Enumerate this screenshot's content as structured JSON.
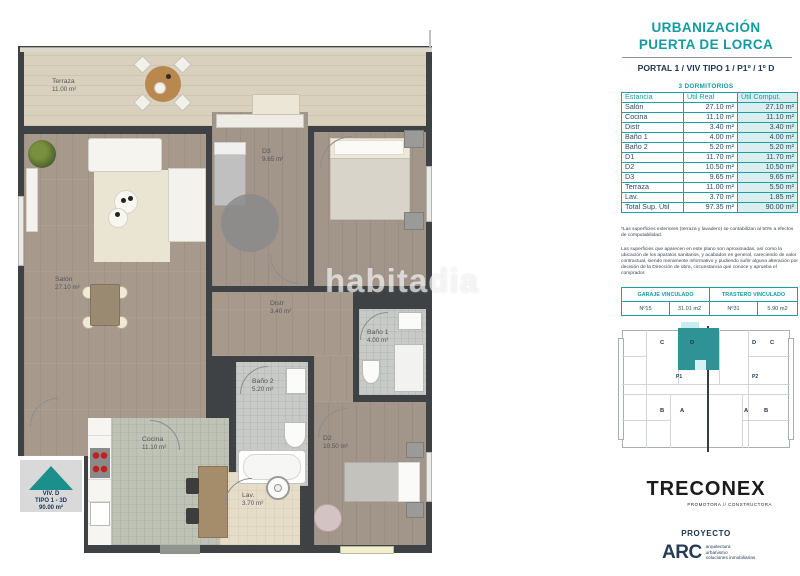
{
  "header": {
    "title_line1": "URBANIZACIÓN",
    "title_line2": "PUERTA DE LORCA",
    "subtitle": "PORTAL 1 / VIV TIPO 1 / P1º / 1º D",
    "bedrooms_label": "3 DORMITORIOS"
  },
  "area_table": {
    "columns": [
      "Estancia",
      "Útil Real",
      "Útil Comput."
    ],
    "rows": [
      [
        "Salón",
        "27.10 m²",
        "27.10 m²"
      ],
      [
        "Cocina",
        "11.10 m²",
        "11.10 m²"
      ],
      [
        "Distr",
        "3.40 m²",
        "3.40 m²"
      ],
      [
        "Baño 1",
        "4.00 m²",
        "4.00 m²"
      ],
      [
        "Baño 2",
        "5.20 m²",
        "5.20 m²"
      ],
      [
        "D1",
        "11.70 m²",
        "11.70 m²"
      ],
      [
        "D2",
        "10.50 m²",
        "10.50 m²"
      ],
      [
        "D3",
        "9.65 m²",
        "9.65 m²"
      ],
      [
        "Terraza",
        "11.00 m²",
        "5.50 m²"
      ],
      [
        "Lav.",
        "3.70 m²",
        "1.85 m²"
      ]
    ],
    "total_row": [
      "Total Sup. Útil",
      "97.35 m²",
      "90.00 m²"
    ]
  },
  "notes": {
    "note1": "*Las superficies exteriores (terraza y lavadero) se contabilizan al 50% a efectos de computabilidad.",
    "note2": "Las superficies que aparecen en este plano son aproximadas, así como la ubicación de los aparatos sanitarios, y acabados en general, careciendo de valor contractual, siendo meramente informativo y pudiendo sufrir alguna alteración por decisión de la Dirección de obra, circunstancia que conoce y aprueba el comprador."
  },
  "linked_table": {
    "garage_header": "GARAJE VINCULADO",
    "storage_header": "TRASTERO VINCULADO",
    "garage_number": "Nº15",
    "garage_area": "31.01 m2",
    "storage_number": "Nº31",
    "storage_area": "5.90 m2"
  },
  "key_plan": {
    "units": [
      "C",
      "D",
      "D",
      "C",
      "B",
      "A",
      "A",
      "B"
    ],
    "portals": [
      "P1",
      "P2"
    ],
    "highlighted_unit": "D"
  },
  "branding": {
    "developer_name": "TRECONEX",
    "developer_tagline": "PROMOTORA // CONSTRUCTORA",
    "project_label": "PROYECTO",
    "architect_name": "ARC",
    "architect_line1": "arquitectura",
    "architect_line2": "urbanismo",
    "architect_line3": "soluciones inmobiliarias"
  },
  "floor_plan": {
    "watermark": "habitadia",
    "entry_badge": {
      "line1": "VIV. D",
      "line2": "TIPO 1 - 3D",
      "line3": "90.00 m²"
    },
    "rooms": [
      {
        "name": "Terraza",
        "area": "11.00 m²"
      },
      {
        "name": "Salón",
        "area": "27.10 m²"
      },
      {
        "name": "D3",
        "area": "9.65 m²"
      },
      {
        "name": "D1",
        "area": "11.70 m²"
      },
      {
        "name": "Distr",
        "area": "3.40 m²"
      },
      {
        "name": "Baño 1",
        "area": "4.00 m²"
      },
      {
        "name": "Baño 2",
        "area": "5.20 m²"
      },
      {
        "name": "Cocina",
        "area": "11.10 m²"
      },
      {
        "name": "Lav.",
        "area": "3.70 m²"
      },
      {
        "name": "D2",
        "area": "10.50 m²"
      }
    ]
  },
  "colors": {
    "accent_teal": "#139ba2",
    "navy": "#1d3550",
    "wall": "#3f4245",
    "keyplan_highlight": "#2f9396",
    "table_shade": "#daeeee"
  }
}
